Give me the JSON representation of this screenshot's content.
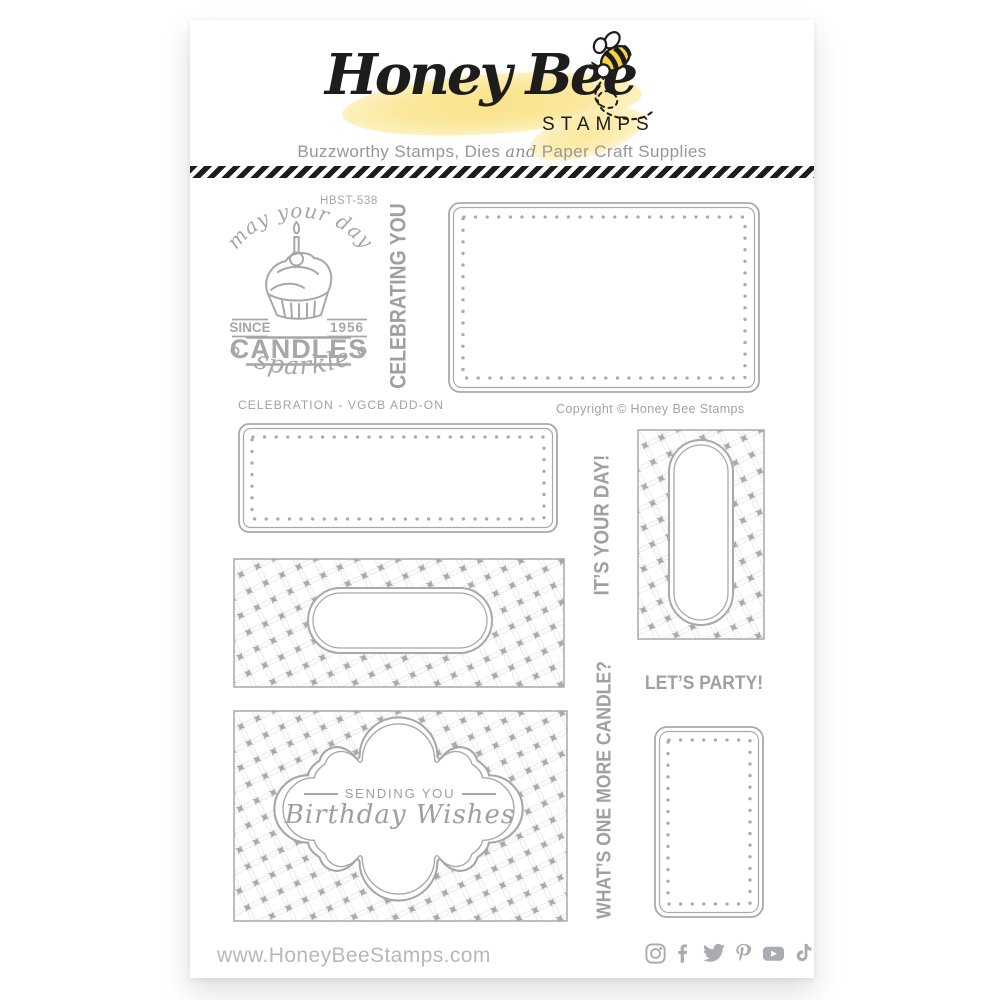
{
  "colors": {
    "ink": "#1d1d1b",
    "stamp_gray": "#a7a7a7",
    "caption_gray": "#a2a2a2",
    "footer_gray": "#b5b8bd",
    "honey_yellow": "#fbe38f"
  },
  "header": {
    "brand_script": "Honey Bee",
    "brand_word": "STAMPS",
    "tagline_part1": "Buzzworthy Stamps, Dies",
    "tagline_and": "and",
    "tagline_part2": "Paper Craft Supplies"
  },
  "sheet": {
    "product_code": "HBST-538",
    "set_name": "CELEBRATION - VGCB ADD-ON",
    "copyright": "Copyright © Honey Bee Stamps"
  },
  "badge": {
    "arc_text": "may your day",
    "since": "SINCE",
    "year": "1956",
    "candles": "CANDLES",
    "sparkle": "sparkle"
  },
  "stamps": {
    "celebrating_you": "CELEBRATING YOU",
    "its_your_day": "IT’S YOUR DAY!",
    "lets_party": "LET’S PARTY!",
    "one_more_candle": "WHAT’S ONE MORE CANDLE?",
    "sending_you": "SENDING YOU",
    "birthday_wishes": "Birthday Wishes"
  },
  "footer": {
    "url": "www.HoneyBeeStamps.com",
    "social_icons": [
      "instagram",
      "facebook",
      "twitter",
      "pinterest",
      "youtube",
      "tiktok"
    ]
  }
}
